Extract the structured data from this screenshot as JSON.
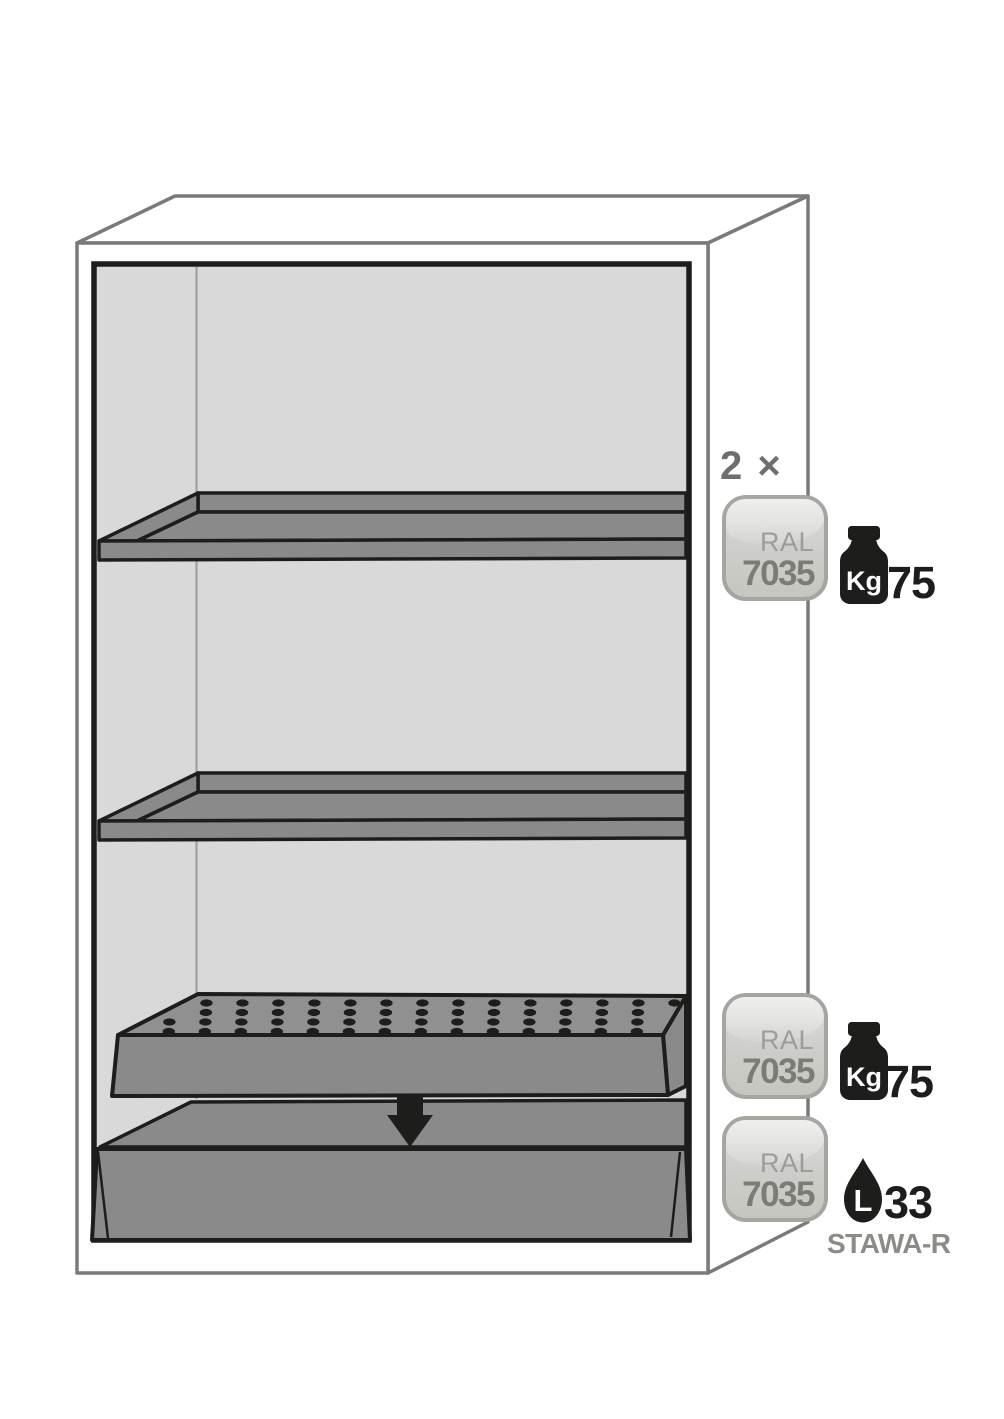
{
  "quantity_label": "2 ×",
  "badges": [
    {
      "ral_label": "RAL",
      "ral_code": "7035"
    },
    {
      "ral_label": "RAL",
      "ral_code": "7035"
    },
    {
      "ral_label": "RAL",
      "ral_code": "7035"
    }
  ],
  "specs": {
    "shelf_load": {
      "unit": "Kg",
      "value": "75"
    },
    "insert_load": {
      "unit": "Kg",
      "value": "75"
    },
    "sump_volume": {
      "unit": "L",
      "value": "33",
      "standard": "STAWA-R"
    }
  },
  "colors": {
    "outline_black": "#1d1d1b",
    "cabinet_line_gray": "#7a7a7a",
    "interior_gray": "#d9d9d9",
    "tray_gray": "#8a8a8a",
    "badge_border": "#a5a5a2",
    "badge_fill": "#cdcdc9",
    "label_gray": "#8b8b87",
    "text_dark_gray": "#6e6e6e"
  }
}
